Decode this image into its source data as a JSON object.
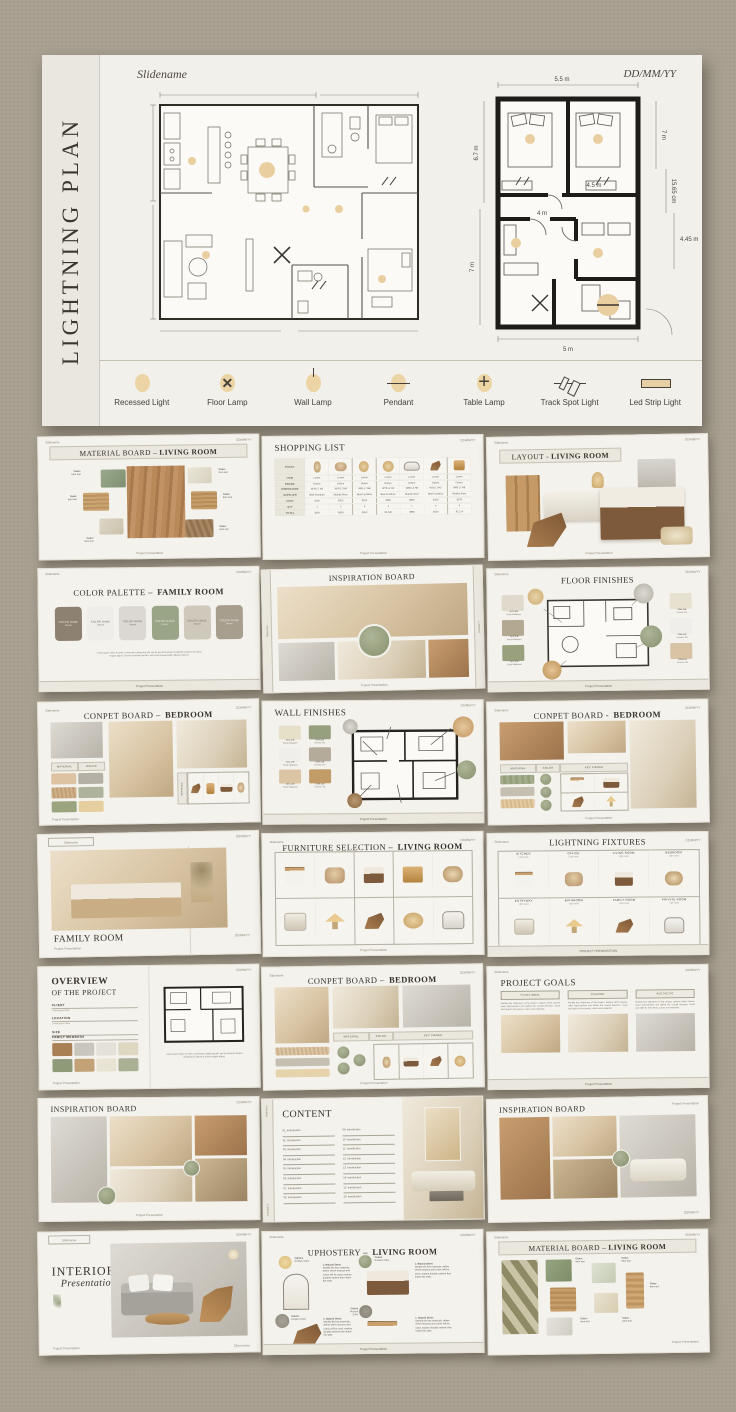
{
  "page": {
    "background": "#a8a091",
    "accent_gold": "#ecd4a5",
    "accent_sage": "#97a083"
  },
  "common": {
    "slidename": "Slidename",
    "date": "DD/MM/YY",
    "footer": "Project Presentation",
    "footer_caps": "PROJECT PRESENTATION",
    "client": "Client name",
    "color_label": "Color:",
    "item_label": "Item text"
  },
  "hero": {
    "side_title": "LIGHTNING PLAN",
    "dims": {
      "top": "5.5 m",
      "right_top": "7 m",
      "right_mid": "15.65 cm",
      "right_low": "4.45 m",
      "left_top": "6.7 m",
      "left_low": "7 m",
      "bottom": "5 m",
      "inner_a": "4.5 m",
      "inner_b": "4 m"
    },
    "legend": [
      {
        "cls": "ic-recessed",
        "icon": "recessed-light-icon",
        "label": "Recessed Light"
      },
      {
        "cls": "ic-floor",
        "icon": "floor-lamp-icon",
        "label": "Floor Lamp"
      },
      {
        "cls": "ic-wall",
        "icon": "wall-lamp-icon",
        "label": "Wall Lamp"
      },
      {
        "cls": "ic-pendant",
        "icon": "pendant-icon",
        "label": "Pendant"
      },
      {
        "cls": "ic-table",
        "icon": "table-lamp-icon",
        "label": "Table Lamp"
      },
      {
        "cls": "ic-track",
        "icon": "track-spot-light-icon",
        "label": "Track Spot Light"
      },
      {
        "cls": "ic-led",
        "icon": "led-strip-light-icon",
        "label": "Led Strip Light"
      }
    ]
  },
  "thumbs": {
    "t1": {
      "tp": "MATERIAL BOARD –",
      "tb": "LIVING ROOM"
    },
    "t2": {
      "title": "SHOPPING LIST",
      "photo_label": "PHOTO",
      "rows": [
        {
          "label": "ITEM",
          "c": [
            "Lorem",
            "Lorem",
            "Lorem",
            "Lorem",
            "Lorem",
            "Lorem",
            "Lorem"
          ]
        },
        {
          "label": "BRAND",
          "c": [
            "Dolore",
            "Dolore",
            "Dolore",
            "Dolore",
            "Dolore",
            "Dolore",
            "Dolore"
          ]
        },
        {
          "label": "DIMENSIONS",
          "c": [
            "W78 L7 H3",
            "W78 L7 H8",
            "W85 L7 H8",
            "W78 L2 H3",
            "W85 L2 H8",
            "W78 L7 H3",
            "W85 L7 H8"
          ]
        },
        {
          "label": "SUPPLIER",
          "c": [
            "Best Furniture",
            "Nearby Store",
            "Best Furniture",
            "Best Furniture",
            "Nearby Store",
            "Best Furniture",
            "Nearby Store"
          ]
        },
        {
          "label": "COST",
          "c": [
            "$150",
            "$315",
            "$150",
            "$385",
            "$850",
            "$150",
            "$278"
          ]
        },
        {
          "label": "QTY",
          "c": [
            "1",
            "2",
            "3",
            "4",
            "1",
            "3",
            "4"
          ]
        },
        {
          "label": "TOTAL",
          "c": [
            "$150",
            "$630",
            "$450",
            "$1,540",
            "$850",
            "$450",
            "$1,114"
          ]
        }
      ]
    },
    "t3": {
      "tp": "LAYOUT -",
      "tb": "LIVING ROOM"
    },
    "t4": {
      "tp": "COLOR PALETTE –",
      "tb": "FAMILY ROOM",
      "swatches": [
        {
          "color": "#8d8171",
          "fg": "#f1efe9",
          "label": "COLOR NAME",
          "sub": "(Name)"
        },
        {
          "color": "#efedea",
          "fg": "#6b665c",
          "label": "COLOR NAME",
          "sub": "(Name)"
        },
        {
          "color": "#dbd8d3",
          "fg": "#6b665c",
          "label": "COLOR NAME",
          "sub": "(Name)"
        },
        {
          "color": "#9aa587",
          "fg": "#f1efe9",
          "label": "COLOR NAME",
          "sub": "(Name)"
        },
        {
          "color": "#cfc9bb",
          "fg": "#6b665c",
          "label": "COLOR NAME",
          "sub": "(Name)"
        },
        {
          "color": "#a89e8e",
          "fg": "#f1efe9",
          "label": "COLOR NAME",
          "sub": "(Name)"
        }
      ],
      "body": "Lorem ipsum dolor sit amet, consectetur adipiscing elit, sed do eiusmod tempor incididunt ut labore et dolore magna aliqua. Ut enim ad minim veniam, quis nostrud exercitation ullamco laboris."
    },
    "t5": {
      "title": "INSPIRATION BOARD"
    },
    "t6": {
      "title": "FLOOR FINISHES",
      "left": [
        {
          "color": "#dfdacb",
          "code": "W73-47B",
          "name": "Floral Wallpaper"
        },
        {
          "color": "#b3a892",
          "code": "W73-47B",
          "name": "Floral Wallpaper"
        },
        {
          "color": "#98a07e",
          "code": "W73-47B",
          "name": "Floral Wallpaper"
        }
      ],
      "right": [
        {
          "color": "#e7e2cf",
          "code": "CRM-11B",
          "name": "Ceramic Tile"
        },
        {
          "color": "#efeeea",
          "code": "CRM-11B",
          "name": "Ceramic Tile"
        },
        {
          "color": "#d8c3a4",
          "code": "CRM-11B",
          "name": "Ceramic Tile"
        }
      ]
    },
    "t7": {
      "tp": "CONPET BOARD –",
      "tb": "BEDROOM",
      "s1": "MATERIAL",
      "s2": "COLOR",
      "s3": "KEY PIECES"
    },
    "t8": {
      "title": "WALL FINISHES",
      "swatches": [
        {
          "color": "#e7e0c9",
          "code": "W73-47B",
          "name": "Floral Wallpaper"
        },
        {
          "color": "#96a07f",
          "code": "CRM-11B",
          "name": "Ceramic Tile"
        },
        {
          "color": "#efeeea",
          "code": "W73-47B",
          "name": "Floral Wallpaper"
        },
        {
          "color": "#b4ab9b",
          "code": "CRM-11B",
          "name": "Ceramic Tile"
        },
        {
          "color": "#dcc5a5",
          "code": "W73-47B",
          "name": "Floral Wallpaper"
        },
        {
          "color": "#c29c66",
          "code": "CRM-11B",
          "name": "Ceramic Tile"
        }
      ]
    },
    "t9": {
      "tp": "CONPET BOARD -",
      "tb": "BEDROOM",
      "s1": "MATERIAL",
      "s2": "COLOR",
      "s3": "KEY PIECES"
    },
    "t10": {
      "title": "FAMILY ROOM"
    },
    "t11": {
      "tp": "FURNITURE SELECTION –",
      "tb": "LIVING ROOM",
      "cells": [
        {
          "art": "a-table"
        },
        {
          "art": "a-pillows"
        },
        {
          "art": "a-bed"
        },
        {
          "art": "a-side"
        },
        {
          "art": "a-vase"
        },
        {
          "art": "a-sofa"
        },
        {
          "art": "a-lamp"
        },
        {
          "art": "a-chair"
        },
        {
          "art": "a-mirror"
        },
        {
          "art": "a-tub"
        }
      ]
    },
    "t12": {
      "title": "LIGHTNING FIXTURES",
      "cells": [
        {
          "room": "KITCHEN",
          "sub": "Light name",
          "art": "a-table"
        },
        {
          "room": "OFFICE",
          "sub": "Light name",
          "art": "a-pillows"
        },
        {
          "room": "LIVING ROOM",
          "sub": "Light name",
          "art": "a-bed"
        },
        {
          "room": "BEDROOM",
          "sub": "Light name",
          "art": "a-vase"
        },
        {
          "room": "ENTRYWAY",
          "sub": "Light name",
          "art": "a-sofa"
        },
        {
          "room": "BATHROOM",
          "sub": "Light name",
          "art": "a-lamp"
        },
        {
          "room": "FAMILY ROOM",
          "sub": "Light name",
          "art": "a-chair"
        },
        {
          "room": "PRIVATE ROOM",
          "sub": "Light name",
          "art": "a-tub"
        }
      ]
    },
    "t13": {
      "t1": "OVERVIEW",
      "t2": "OF THE PROJECT",
      "fields": [
        {
          "label": "CLIENT",
          "value": "Lorem ipsum dolor"
        },
        {
          "label": "LOCATION",
          "value": "Lorem ipsum dolor"
        },
        {
          "label": "SIZE",
          "value": "Lorem ipsum dolor"
        }
      ],
      "members": "FAMILY MEMBERS",
      "colors": [
        "#a97f54",
        "#c9c7bd",
        "#e4e1d8",
        "#ded8c3",
        "#8f9a78",
        "#c2a276",
        "#e8e3d3",
        "#aab093"
      ],
      "body": "Lorem ipsum dolor sit amet, consectetur adipiscing elit, sed do eiusmod tempor incididunt ut labore et dolore magna aliqua."
    },
    "t14": {
      "tp": "CONPET BOARD –",
      "tb": "BEDROOM",
      "s1": "MATERIAL",
      "s2": "COLOR",
      "s3": "KEY PIECES"
    },
    "t15": {
      "title": "PROJECT GOALS",
      "goals": [
        {
          "header": "FUNCTIONAL",
          "ph": "ph",
          "body": "Identify key objectives of the project, explore which spaces need improvement and define the overall direction, mood and style for the interior, colors and materials."
        },
        {
          "header": "CALMING",
          "ph": "ph2",
          "body": "Identify key objectives of the project, explore which spaces need improvement and define the overall direction, mood and style for the interior, colors and materials."
        },
        {
          "header": "AESTHETIC",
          "ph": "ph-gray",
          "body": "Identify key objectives of the project, explore which spaces need improvement and define the overall direction, mood and style for the interior, colors and materials."
        }
      ]
    },
    "t16": {
      "title": "INSPIRATION BOARD"
    },
    "t17": {
      "title": "CONTENT",
      "col1": [
        "01. Introduction",
        "02. Introduction",
        "03. Introduction",
        "04. Introduction",
        "05. Introduction",
        "06. Introduction",
        "07. Introduction",
        "08. Introduction"
      ],
      "col2": [
        "09. Introduction",
        "10. Introduction",
        "11. Introduction",
        "12. Introduction",
        "13. Introduction",
        "14. Introduction",
        "15. Introduction",
        "16. Introduction"
      ]
    },
    "t18": {
      "title": "INSPIRATION BOARD"
    },
    "t19": {
      "t1": "INTERIOR",
      "t2": "Presentation"
    },
    "t20": {
      "tp": "UPHOSTERY –",
      "tb": "LIVING ROOM",
      "circles": [
        {
          "label": "Fabrics",
          "sub": "Product Color"
        },
        {
          "label": "Colors",
          "sub": "Product Color"
        },
        {
          "label": "Colors",
          "sub": "Product Color"
        },
        {
          "label": "Colors",
          "sub": "Product Color"
        }
      ],
      "blocks": [
        {
          "title": "1. Natural Stone",
          "body": "Identify the key materials, define which textures and colors will be used, explore durable options that match the style."
        },
        {
          "title": "1. Natural Stone",
          "body": "Identify the key materials, define which textures and colors will be used, explore durable options that match the style."
        },
        {
          "title": "1. Natural Stone",
          "body": "Identify the key materials, define which textures and colors will be used, explore durable options that match the style."
        },
        {
          "title": "1. Natural Stone",
          "body": "Identify the key materials, define which textures and colors will be used, explore durable options that match the style."
        }
      ]
    },
    "t21": {
      "tp": "MATERIAL BOARD –",
      "tb": "LIVING ROOM"
    }
  }
}
